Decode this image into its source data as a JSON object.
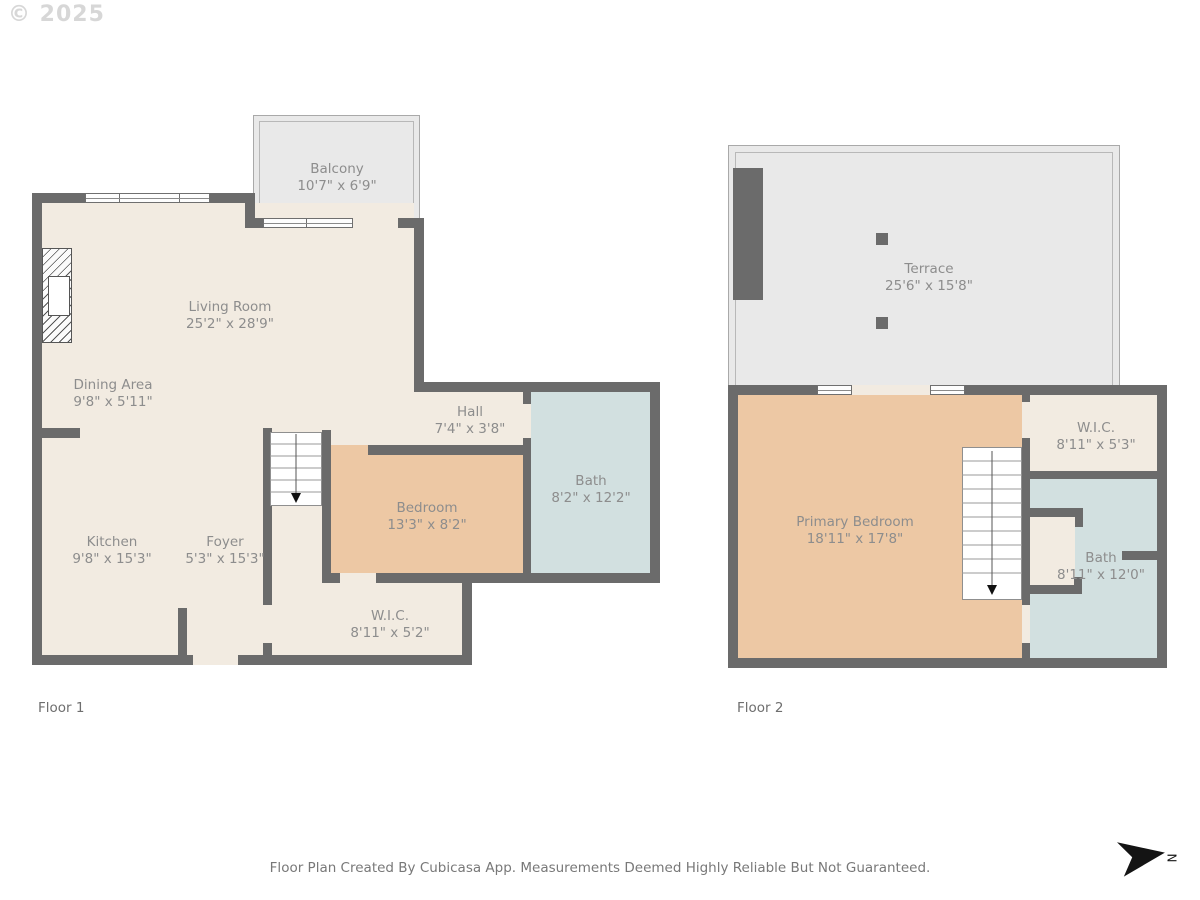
{
  "watermark": "© 2025",
  "disclaimer": "Floor Plan Created By Cubicasa App. Measurements Deemed Highly Reliable But Not Guaranteed.",
  "north_label": "N",
  "colors": {
    "wall": "#6b6b6b",
    "floor_cream": "#f2ebe1",
    "bedroom_tan": "#edc8a4",
    "bath_blue": "#d2e0e0",
    "outdoor_gray": "#e9e9e9",
    "label_text": "#8d8d8d"
  },
  "floor1": {
    "label": "Floor 1",
    "rooms": [
      {
        "name": "Balcony",
        "dims": "10'7\" x 6'9\""
      },
      {
        "name": "Living Room",
        "dims": "25'2\" x 28'9\""
      },
      {
        "name": "Dining Area",
        "dims": "9'8\" x 5'11\""
      },
      {
        "name": "Hall",
        "dims": "7'4\" x 3'8\""
      },
      {
        "name": "Bath",
        "dims": "8'2\" x 12'2\""
      },
      {
        "name": "Bedroom",
        "dims": "13'3\" x 8'2\""
      },
      {
        "name": "Kitchen",
        "dims": "9'8\" x 15'3\""
      },
      {
        "name": "Foyer",
        "dims": "5'3\" x 15'3\""
      },
      {
        "name": "W.I.C.",
        "dims": "8'11\" x 5'2\""
      }
    ]
  },
  "floor2": {
    "label": "Floor 2",
    "rooms": [
      {
        "name": "Terrace",
        "dims": "25'6\" x 15'8\""
      },
      {
        "name": "W.I.C.",
        "dims": "8'11\" x 5'3\""
      },
      {
        "name": "Primary Bedroom",
        "dims": "18'11\" x 17'8\""
      },
      {
        "name": "Bath",
        "dims": "8'11\" x 12'0\""
      }
    ]
  }
}
